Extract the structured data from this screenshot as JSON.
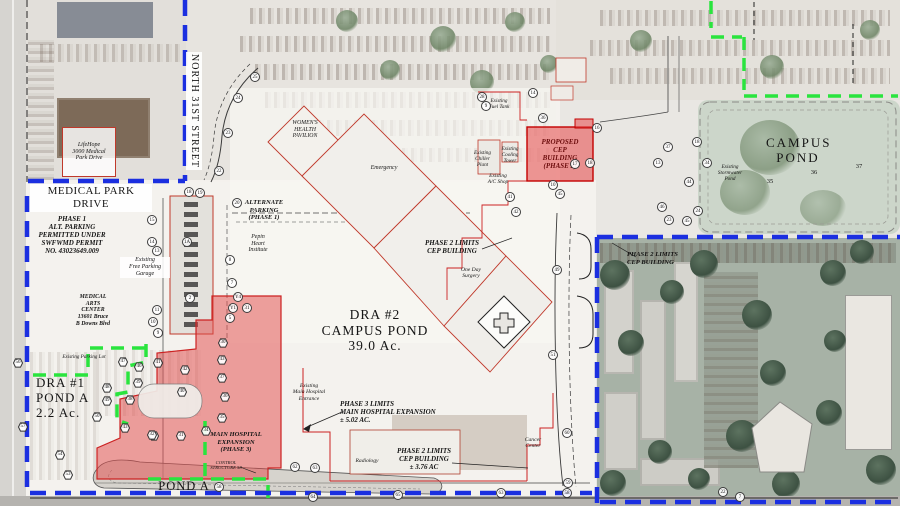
{
  "title": "Hospital Campus Drainage & Phasing Site Plan",
  "colors": {
    "boundary_blue": "#1b2fe0",
    "limits_green": "#2ae43e",
    "phase_red_line": "#cc2222",
    "phase_red_fill": "#e14646",
    "cad_black": "#333333"
  },
  "labels": {
    "medical_park_drive": "MEDICAL PARK DRIVE",
    "north_31st_street": "NORTH 31ST STREET",
    "lifehope": "LifeHope\n3000 Medical\nPark Drive",
    "phase1_alt_parking": "PHASE 1\nALT. PARKING\nPERMITTED UNDER\nSWFWMD PERMIT\nNO. 43023649.009",
    "free_parking_garage": "Existing\nFree Parking\nGarage",
    "medical_arts_center": "MEDICAL\nARTS\nCENTER\n13601 Bruce\nB Downs Blvd",
    "alternate_parking": "ALTERNATE\nPARKING\n(PHASE 1)",
    "pepin_heart": "Pepin\nHeart\nInstitute",
    "womens_health": "WOMEN'S\nHEALTH\nPAVILION",
    "emergency": "Emergency",
    "existing_fuel": "Existing\nFuel Tank",
    "existing_chiller": "Existing\nChiller\nPlant",
    "existing_cooling": "Existing\nCooling\nTower",
    "existing_ac_shop": "Existing\nA/C Shop",
    "proposed_cep": "PROPOSED\nCEP\nBUILDING\n(PHASE 2)",
    "campus_pond_ne": "CAMPUS\nPOND",
    "existing_stormwater": "Existing\nStormwater\nPond",
    "dra2": "DRA #2\nCAMPUS POND\n39.0 Ac.",
    "one_day_surgery": "One Day\nSurgery",
    "phase2_limits_center": "PHASE 2 LIMITS\nCEP BUILDING",
    "phase3_limits": "PHASE 3 LIMITS\nMAIN HOSPITAL EXPANSION\n± 5.02 AC.",
    "main_hospital_entrance": "Existing\nMain Hospital\nEntrance",
    "main_hospital_expansion": "MAIN HOSPITAL\nEXPANSION\n(PHASE 3)",
    "control_structure": "CONTROL\nSTRUCTURE 58",
    "phase2_limits_bottom": "PHASE 2 LIMITS\nCEP BUILDING\n± 3.76 AC",
    "radiology": "Radiology",
    "cancer_center": "Cancer\nCenter",
    "phase2_limits_right": "PHASE 2 LIMITS\nCEP BUILDING",
    "dra1_block": "DRA #1\nPOND A\n2.2 Ac.",
    "pond_a_bottom": "POND A",
    "existing_parking_lot": "Existing Parking Lot"
  },
  "markers": [
    {
      "n": "25",
      "x": 255,
      "y": 77,
      "s": "c"
    },
    {
      "n": "24",
      "x": 238,
      "y": 98,
      "s": "c"
    },
    {
      "n": "23",
      "x": 228,
      "y": 133,
      "s": "c"
    },
    {
      "n": "22",
      "x": 219,
      "y": 171,
      "s": "c"
    },
    {
      "n": "18",
      "x": 189,
      "y": 192,
      "s": "c"
    },
    {
      "n": "19",
      "x": 200,
      "y": 193,
      "s": "c"
    },
    {
      "n": "20",
      "x": 237,
      "y": 203,
      "s": "c"
    },
    {
      "n": "1A",
      "x": 187,
      "y": 242,
      "s": "c"
    },
    {
      "n": "15",
      "x": 152,
      "y": 220,
      "s": "c"
    },
    {
      "n": "14",
      "x": 152,
      "y": 242,
      "s": "c"
    },
    {
      "n": "13",
      "x": 157,
      "y": 251,
      "s": "c"
    },
    {
      "n": "8",
      "x": 230,
      "y": 260,
      "s": "c"
    },
    {
      "n": "7",
      "x": 232,
      "y": 283,
      "s": "c"
    },
    {
      "n": "Y4",
      "x": 238,
      "y": 297,
      "s": "c"
    },
    {
      "n": "Y1",
      "x": 233,
      "y": 308,
      "s": "c"
    },
    {
      "n": "31",
      "x": 247,
      "y": 308,
      "s": "c"
    },
    {
      "n": "5",
      "x": 230,
      "y": 318,
      "s": "c"
    },
    {
      "n": "2",
      "x": 190,
      "y": 298,
      "s": "c"
    },
    {
      "n": "11",
      "x": 157,
      "y": 310,
      "s": "c"
    },
    {
      "n": "10",
      "x": 153,
      "y": 322,
      "s": "c"
    },
    {
      "n": "9",
      "x": 158,
      "y": 333,
      "s": "c"
    },
    {
      "n": "28",
      "x": 482,
      "y": 97,
      "s": "c"
    },
    {
      "n": "9",
      "x": 486,
      "y": 106,
      "s": "c"
    },
    {
      "n": "14",
      "x": 533,
      "y": 93,
      "s": "c"
    },
    {
      "n": "36",
      "x": 543,
      "y": 118,
      "s": "c"
    },
    {
      "n": "16",
      "x": 597,
      "y": 128,
      "s": "c"
    },
    {
      "n": "17",
      "x": 575,
      "y": 164,
      "s": "c"
    },
    {
      "n": "18",
      "x": 590,
      "y": 163,
      "s": "c"
    },
    {
      "n": "10",
      "x": 553,
      "y": 185,
      "s": "c"
    },
    {
      "n": "45",
      "x": 560,
      "y": 194,
      "s": "c"
    },
    {
      "n": "41",
      "x": 510,
      "y": 197,
      "s": "c"
    },
    {
      "n": "42",
      "x": 516,
      "y": 212,
      "s": "c"
    },
    {
      "n": "37",
      "x": 668,
      "y": 147,
      "s": "c"
    },
    {
      "n": "13",
      "x": 658,
      "y": 163,
      "s": "c"
    },
    {
      "n": "34",
      "x": 707,
      "y": 163,
      "s": "c"
    },
    {
      "n": "44",
      "x": 689,
      "y": 182,
      "s": "c"
    },
    {
      "n": "18",
      "x": 697,
      "y": 142,
      "s": "c"
    },
    {
      "n": "46",
      "x": 662,
      "y": 207,
      "s": "c"
    },
    {
      "n": "24",
      "x": 698,
      "y": 211,
      "s": "c"
    },
    {
      "n": "23",
      "x": 669,
      "y": 220,
      "s": "c"
    },
    {
      "n": "45",
      "x": 687,
      "y": 221,
      "s": "c"
    },
    {
      "n": "35",
      "x": 768,
      "y": 182,
      "s": "t"
    },
    {
      "n": "36",
      "x": 812,
      "y": 173,
      "s": "t"
    },
    {
      "n": "37",
      "x": 857,
      "y": 167,
      "s": "t"
    },
    {
      "n": "56",
      "x": 18,
      "y": 363,
      "s": "h"
    },
    {
      "n": "57",
      "x": 23,
      "y": 427,
      "s": "h"
    },
    {
      "n": "47",
      "x": 123,
      "y": 362,
      "s": "h"
    },
    {
      "n": "46",
      "x": 139,
      "y": 367,
      "s": "h"
    },
    {
      "n": "41",
      "x": 158,
      "y": 363,
      "s": "h"
    },
    {
      "n": "42",
      "x": 185,
      "y": 370,
      "s": "h"
    },
    {
      "n": "48",
      "x": 107,
      "y": 388,
      "s": "h"
    },
    {
      "n": "39",
      "x": 138,
      "y": 383,
      "s": "h"
    },
    {
      "n": "38",
      "x": 130,
      "y": 400,
      "s": "h"
    },
    {
      "n": "49",
      "x": 107,
      "y": 401,
      "s": "h"
    },
    {
      "n": "40",
      "x": 182,
      "y": 392,
      "s": "h"
    },
    {
      "n": "50",
      "x": 97,
      "y": 417,
      "s": "h"
    },
    {
      "n": "43",
      "x": 125,
      "y": 428,
      "s": "h"
    },
    {
      "n": "52",
      "x": 154,
      "y": 436,
      "s": "h"
    },
    {
      "n": "53",
      "x": 68,
      "y": 475,
      "s": "h"
    },
    {
      "n": "54",
      "x": 60,
      "y": 455,
      "s": "h"
    },
    {
      "n": "30",
      "x": 223,
      "y": 343,
      "s": "h"
    },
    {
      "n": "43",
      "x": 222,
      "y": 360,
      "s": "h"
    },
    {
      "n": "37",
      "x": 222,
      "y": 378,
      "s": "h"
    },
    {
      "n": "36",
      "x": 225,
      "y": 397,
      "s": "h"
    },
    {
      "n": "35",
      "x": 222,
      "y": 418,
      "s": "h"
    },
    {
      "n": "34",
      "x": 206,
      "y": 431,
      "s": "h"
    },
    {
      "n": "32",
      "x": 152,
      "y": 435,
      "s": "h"
    },
    {
      "n": "31",
      "x": 181,
      "y": 436,
      "s": "h"
    },
    {
      "n": "51",
      "x": 553,
      "y": 355,
      "s": "c"
    },
    {
      "n": "49",
      "x": 557,
      "y": 270,
      "s": "c"
    },
    {
      "n": "62",
      "x": 295,
      "y": 467,
      "s": "c"
    },
    {
      "n": "63",
      "x": 315,
      "y": 468,
      "s": "c"
    },
    {
      "n": "64",
      "x": 313,
      "y": 497,
      "s": "c"
    },
    {
      "n": "65",
      "x": 398,
      "y": 495,
      "s": "c"
    },
    {
      "n": "60",
      "x": 567,
      "y": 433,
      "s": "c"
    },
    {
      "n": "59",
      "x": 568,
      "y": 483,
      "s": "c"
    },
    {
      "n": "58",
      "x": 567,
      "y": 493,
      "s": "c"
    },
    {
      "n": "63",
      "x": 501,
      "y": 493,
      "s": "c"
    },
    {
      "n": "58",
      "x": 219,
      "y": 487,
      "s": "c"
    },
    {
      "n": "22",
      "x": 723,
      "y": 492,
      "s": "c"
    },
    {
      "n": "7",
      "x": 740,
      "y": 497,
      "s": "c"
    }
  ]
}
